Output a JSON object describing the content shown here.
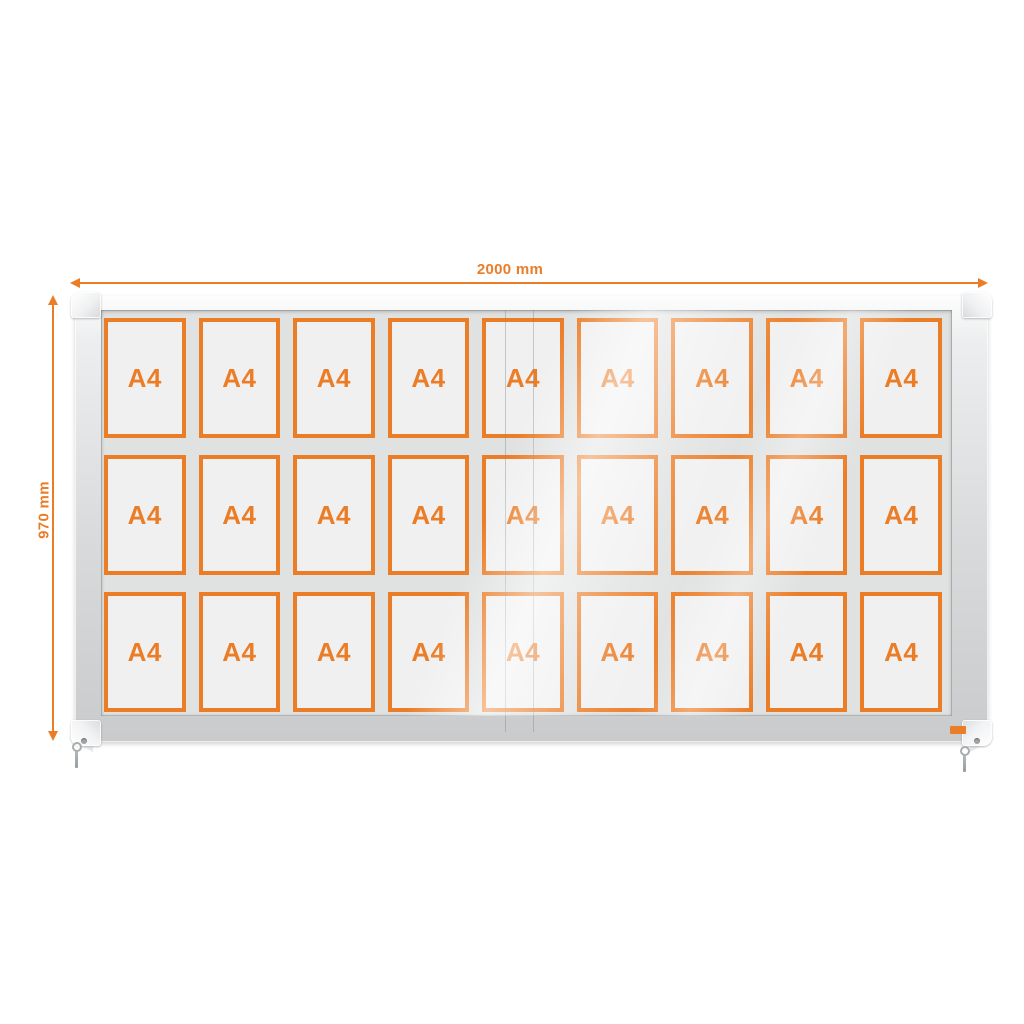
{
  "dimensions": {
    "width": {
      "label": "2000 mm"
    },
    "height": {
      "label": "970 mm"
    }
  },
  "board": {
    "rows": 3,
    "columns": 9,
    "cells": [
      "A4",
      "A4",
      "A4",
      "A4",
      "A4",
      "A4",
      "A4",
      "A4",
      "A4",
      "A4",
      "A4",
      "A4",
      "A4",
      "A4",
      "A4",
      "A4",
      "A4",
      "A4",
      "A4",
      "A4",
      "A4",
      "A4",
      "A4",
      "A4",
      "A4",
      "A4",
      "A4"
    ]
  },
  "colors": {
    "accent": "#EB7D27",
    "frame_silver": "#D8DADB",
    "board_background": "#E0E1E1",
    "card_fill": "#F0F0F0"
  }
}
